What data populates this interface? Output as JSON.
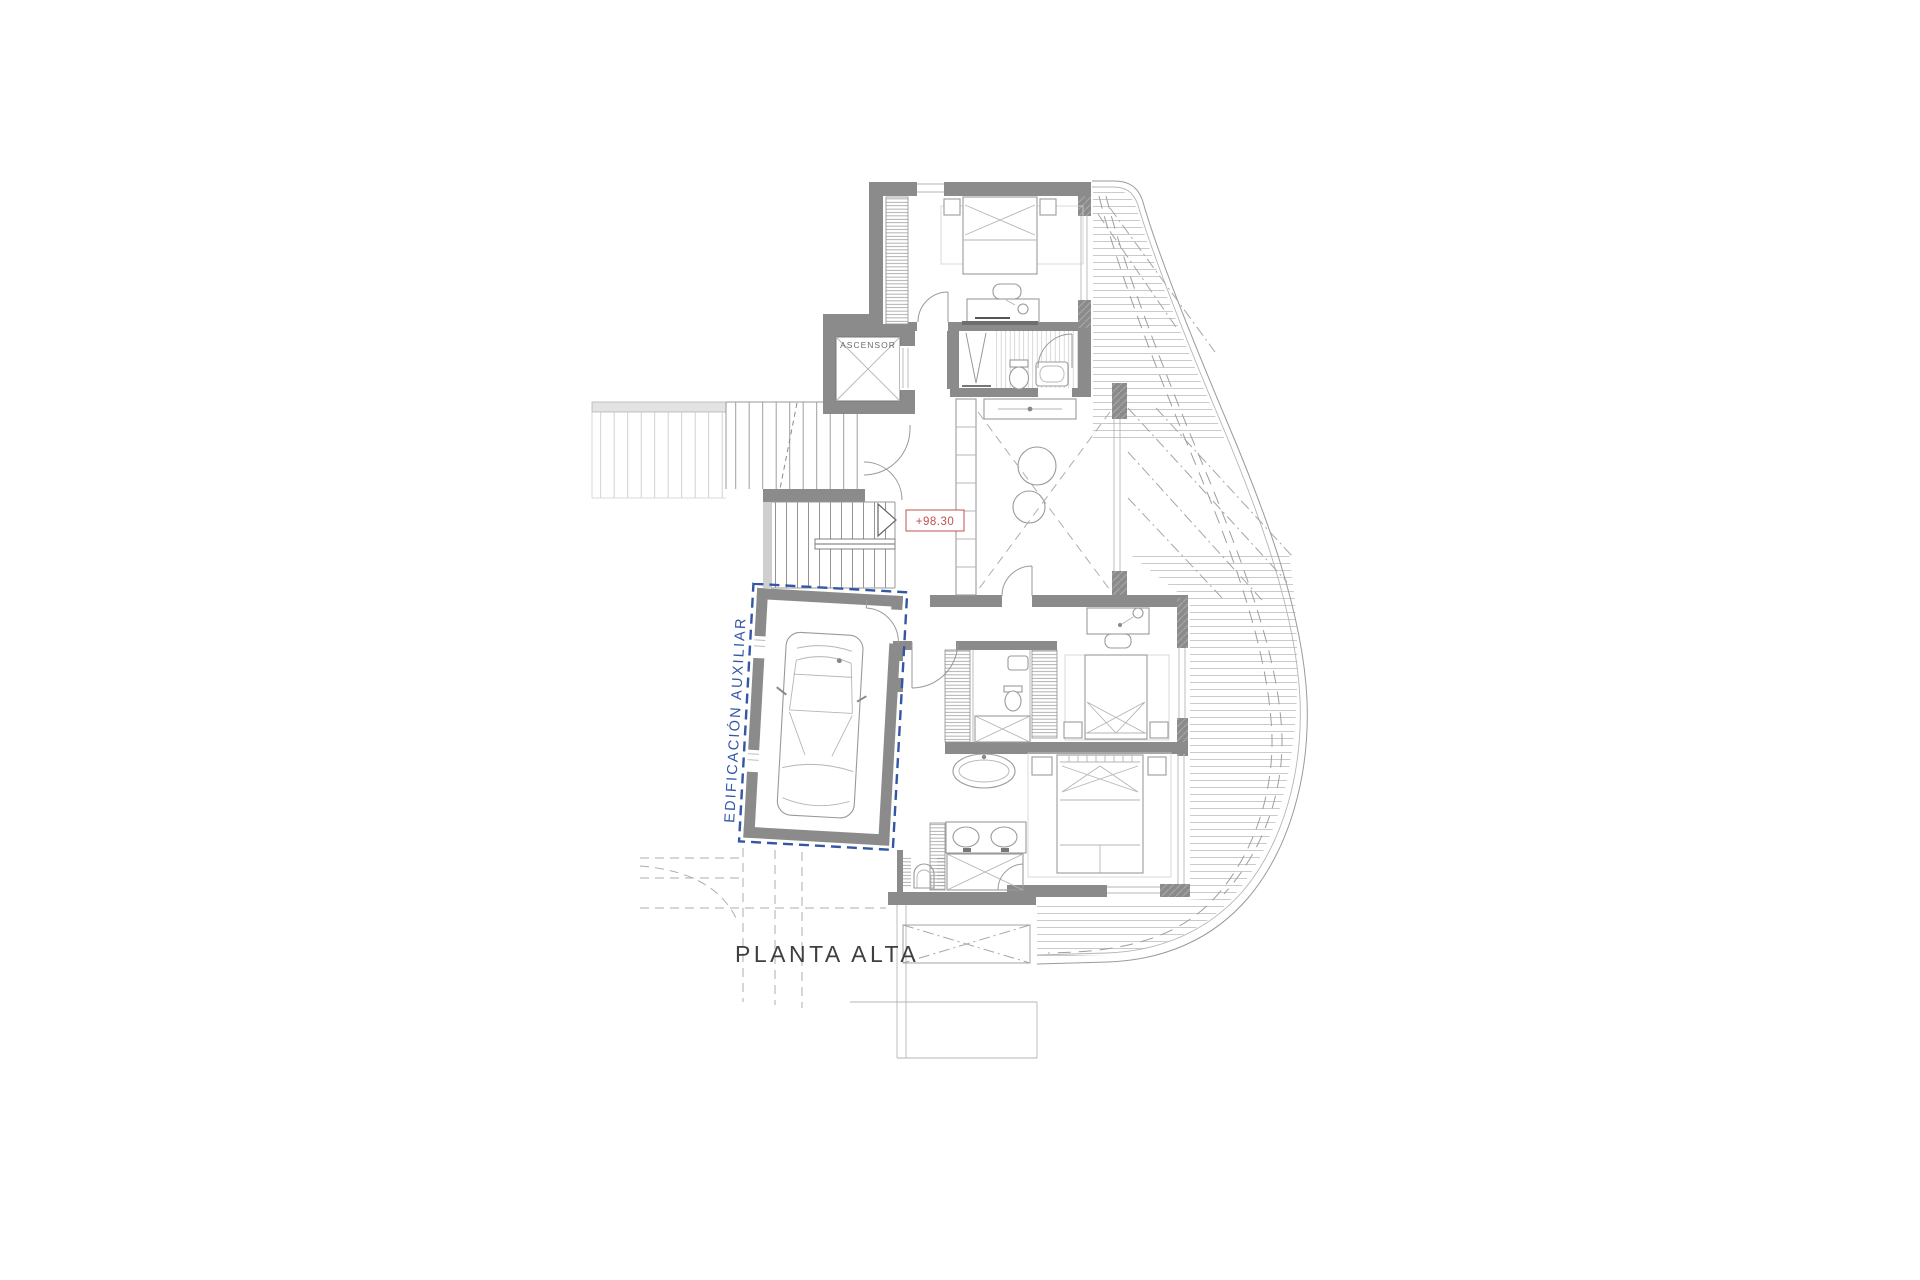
{
  "labels": {
    "elevator": "ASCENSOR",
    "level": "+98.30",
    "auxiliary": "EDIFICACIÓN AUXILIAR",
    "title": "PLANTA ALTA"
  },
  "colors": {
    "wall": "#8b8b8b",
    "accent_blue": "#3356a5",
    "accent_red": "#c0504d",
    "text": "#3f3f3f",
    "background": "#ffffff"
  }
}
